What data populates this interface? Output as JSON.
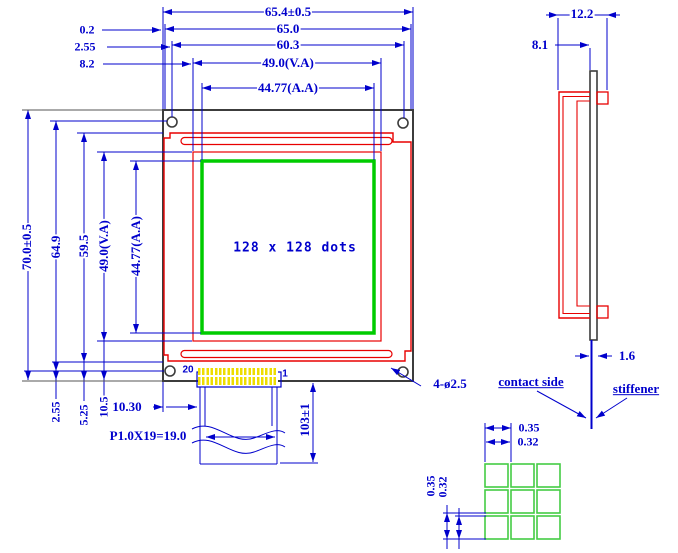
{
  "colors": {
    "dimension_blue": "#0000cc",
    "outline_red": "#e80000",
    "active_area_green": "#00cc00",
    "dot_green": "#44cc44",
    "pcb_outline_black": "#3c3c3c",
    "pin_yellow": "#eedd00"
  },
  "front_view": {
    "display_text": "128 x 128 dots",
    "holes_label": "4-ø2.5",
    "h_dims": {
      "overall": "65.4±0.5",
      "board": "65.0",
      "holes": "60.3",
      "viewing_area": "49.0(V.A)",
      "active_area": "44.77(A.A)"
    },
    "h_offsets": {
      "board_edge": "0.2",
      "hole_edge": "2.55",
      "viewing_edge": "8.2"
    },
    "v_dims": {
      "overall": "70.0±0.5",
      "holes": "64.9",
      "bezel": "59.5",
      "viewing_area": "49.0(V.A)",
      "active_area": "44.77(A.A)"
    },
    "v_offsets": {
      "hole_edge": "2.55",
      "bezel_edge": "5.25",
      "viewing_edge": "10.5"
    },
    "connector": {
      "pin_last": "20",
      "pin_first": "1",
      "edge_offset": "10.30",
      "pitch": "P1.0X19=19.0",
      "tail_length": "103±1"
    }
  },
  "side_view": {
    "dims": {
      "overall_depth": "12.2",
      "bezel_depth": "8.1",
      "pcb_thickness": "1.6"
    },
    "contact_label": "contact side",
    "stiffener_label": "stiffener"
  },
  "dot_detail": {
    "h_pitch": "0.35",
    "h_dot": "0.32",
    "v_pitch": "0.35",
    "v_dot": "0.32"
  }
}
